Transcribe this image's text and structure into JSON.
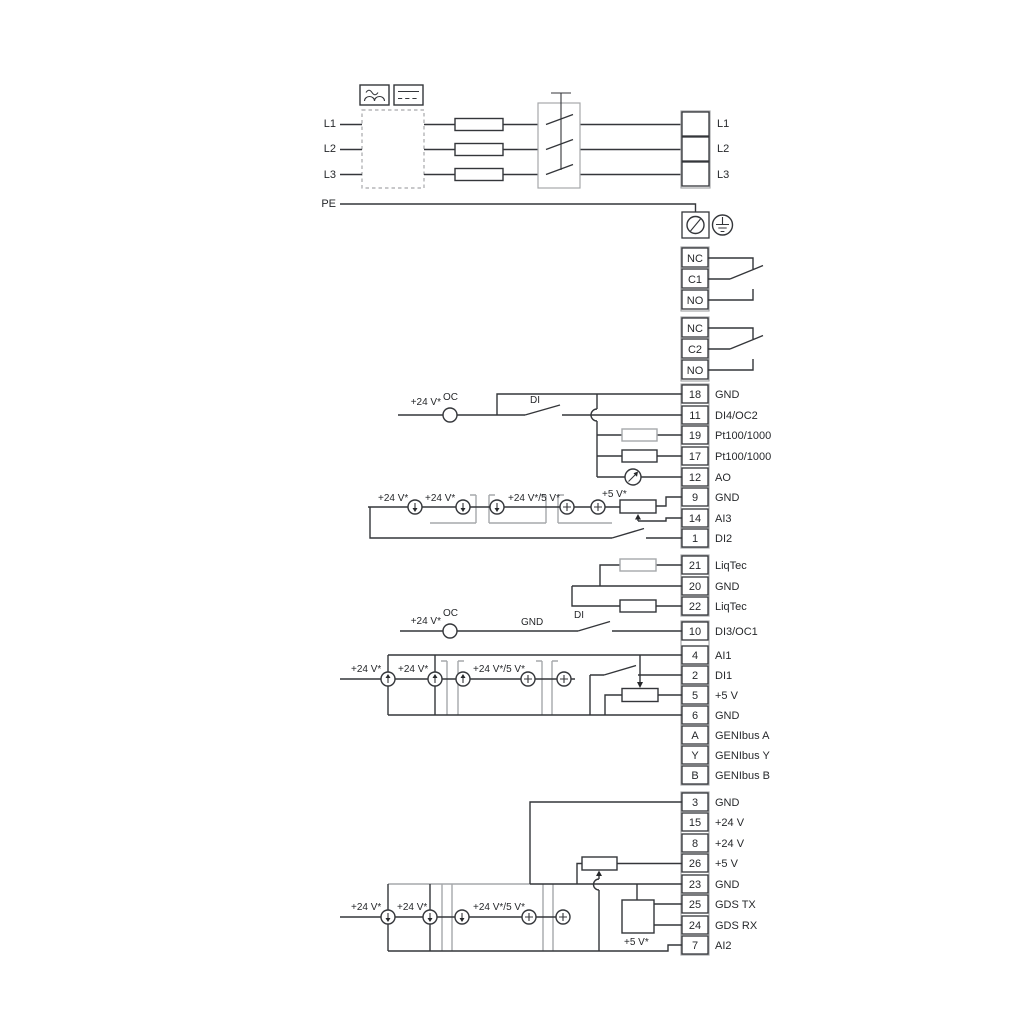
{
  "labels": {
    "v24": "+24 V*",
    "v24_5": "+24 V*/5 V*",
    "v5": "+5 V*",
    "oc": "OC",
    "di": "DI",
    "gnd": "GND"
  },
  "mains": {
    "in": [
      "L1",
      "L2",
      "L3",
      "PE"
    ],
    "out": [
      "L1",
      "L2",
      "L3"
    ]
  },
  "relay1": [
    "NC",
    "C1",
    "NO"
  ],
  "relay2": [
    "NC",
    "C2",
    "NO"
  ],
  "blockA": [
    {
      "n": "18",
      "l": "GND"
    },
    {
      "n": "11",
      "l": "DI4/OC2"
    },
    {
      "n": "19",
      "l": "Pt100/1000"
    },
    {
      "n": "17",
      "l": "Pt100/1000"
    },
    {
      "n": "12",
      "l": "AO"
    },
    {
      "n": "9",
      "l": "GND"
    },
    {
      "n": "14",
      "l": "AI3"
    },
    {
      "n": "1",
      "l": "DI2"
    }
  ],
  "blockB": [
    {
      "n": "21",
      "l": "LiqTec"
    },
    {
      "n": "20",
      "l": "GND"
    },
    {
      "n": "22",
      "l": "LiqTec"
    }
  ],
  "blockC": [
    {
      "n": "10",
      "l": "DI3/OC1"
    },
    {
      "n": "4",
      "l": "AI1"
    },
    {
      "n": "2",
      "l": "DI1"
    },
    {
      "n": "5",
      "l": "+5 V"
    },
    {
      "n": "6",
      "l": "GND"
    },
    {
      "n": "A",
      "l": "GENIbus A"
    },
    {
      "n": "Y",
      "l": "GENIbus Y"
    },
    {
      "n": "B",
      "l": "GENIbus B"
    }
  ],
  "blockD": [
    {
      "n": "3",
      "l": "GND"
    },
    {
      "n": "15",
      "l": "+24 V"
    },
    {
      "n": "8",
      "l": "+24 V"
    },
    {
      "n": "26",
      "l": "+5 V"
    },
    {
      "n": "23",
      "l": "GND"
    },
    {
      "n": "25",
      "l": "GDS TX"
    },
    {
      "n": "24",
      "l": "GDS RX"
    },
    {
      "n": "7",
      "l": "AI2"
    }
  ]
}
